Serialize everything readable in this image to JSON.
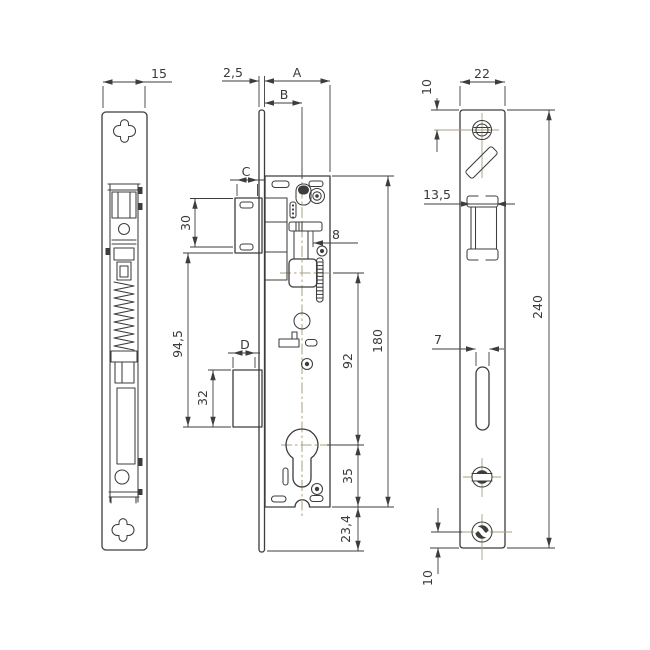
{
  "drawing": {
    "subject": "mortise lock technical drawing, three orthographic views",
    "colors": {
      "line": "#3d3d3d",
      "centerline": "#a89f7c",
      "background": "#ffffff"
    },
    "views": {
      "side": {
        "label": "side view",
        "dims": {
          "width": "15"
        }
      },
      "front": {
        "label": "front view of lock case",
        "dims": {
          "faceplate_thickness": "2,5",
          "backset_a": "A",
          "backset_b": "B",
          "latch_pocket_c": "C",
          "lower_pocket_d": "D",
          "latch_pocket_height": "30",
          "pocket_spacing": "94,5",
          "lower_pocket_height": "32",
          "latch_offset": "8",
          "spindle_to_cylinder": "92",
          "case_height": "180",
          "cylinder_to_case_bottom": "35",
          "case_to_plate_bottom": "23,4"
        }
      },
      "faceplate": {
        "label": "faceplate view",
        "dims": {
          "width": "22",
          "top_screw_offset": "10",
          "latch_width": "13,5",
          "slot_width": "7",
          "height": "240",
          "bottom_screw_offset": "10"
        }
      }
    }
  }
}
